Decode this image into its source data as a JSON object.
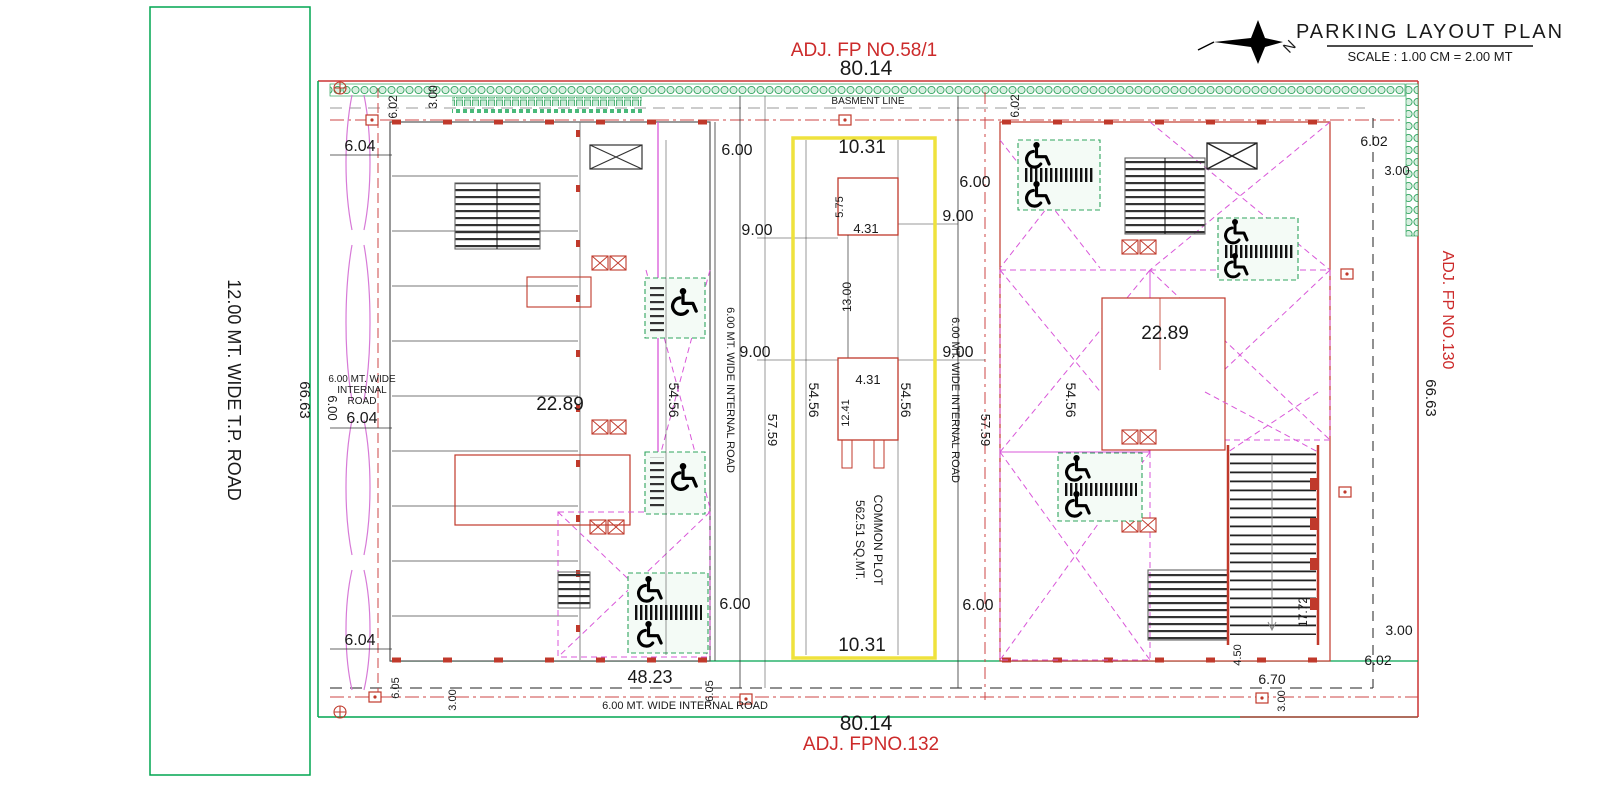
{
  "title": {
    "main": "PARKING LAYOUT PLAN",
    "scale": "SCALE : 1.00 CM = 2.00 MT",
    "north": "N"
  },
  "adjacent": {
    "top": "ADJ.  FP NO.58/1",
    "bottom": "ADJ.  FPNO.132",
    "right": "ADJ. FP NO.130"
  },
  "roads": {
    "tp_road": "12.00 MT. WIDE T.P. ROAD",
    "internal": "6.00 MT. WIDE INTERNAL ROAD",
    "internal_line1": "6.00 MT. WIDE",
    "internal_line2": "INTERNAL",
    "internal_line3": "ROAD",
    "basement": "BASMENT LINE"
  },
  "common_plot": {
    "label": "COMMON PLOT",
    "area": "562.51 SQ.MT."
  },
  "dims": {
    "plot_width": "80.14",
    "plot_height": "66.63",
    "common_width": "10.31",
    "block_width_left": "48.23",
    "block_dim": "22.89",
    "len_54": "54.56",
    "len_57": "57.59",
    "d600": "6.00",
    "d900": "9.00",
    "d604": "6.04",
    "d602": "6.02",
    "d605": "6.05",
    "d300": "3.00",
    "d431": "4.31",
    "d575": "5.75",
    "d1300": "13.00",
    "d1241": "12.41",
    "d1772": "17.72",
    "d450": "4.50",
    "d670": "6.70"
  }
}
